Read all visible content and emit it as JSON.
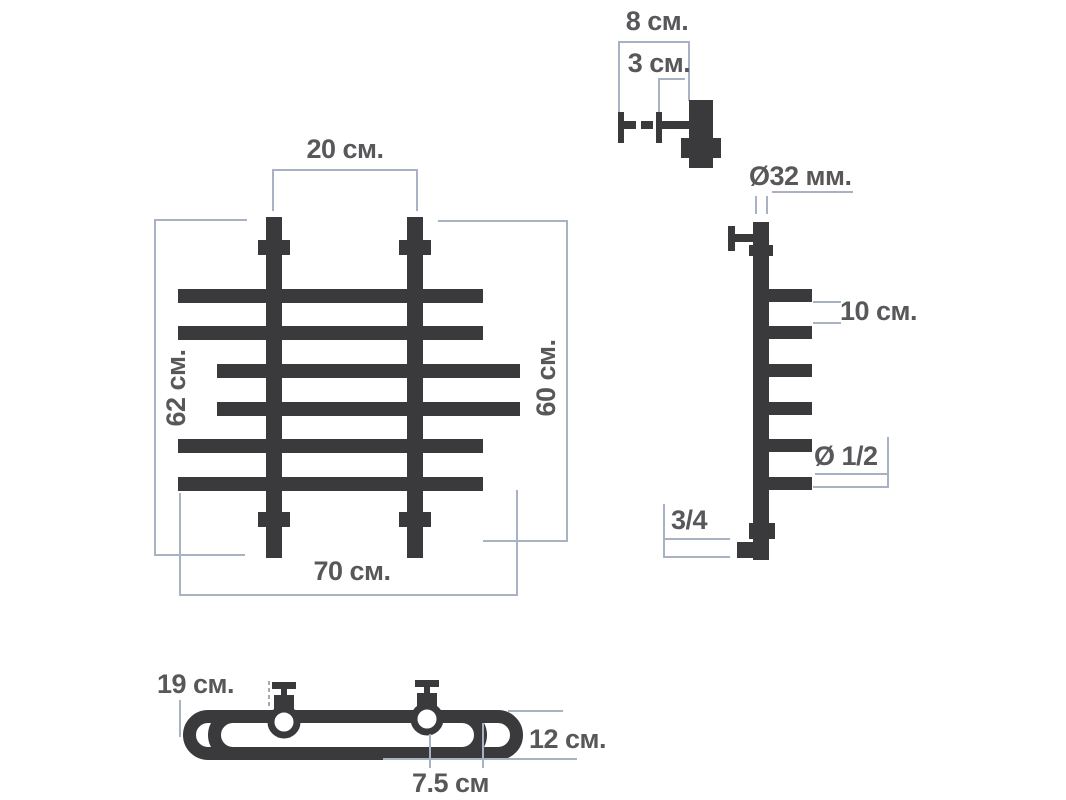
{
  "colors": {
    "pipe": "#3a3a3c",
    "dim": "#a8b2c2",
    "text": "#58585b",
    "dash": "#a9a9ad"
  },
  "front_view": {
    "top_width": "20 см.",
    "left_height": "62 см.",
    "right_height": "60 см.",
    "bottom_width": "70 см."
  },
  "bracket_detail": {
    "total_depth": "8 см.",
    "adjust_depth": "3 см."
  },
  "side_view": {
    "post_diameter": "Ø32 мм.",
    "bar_spacing": "10 см.",
    "bar_diameter": "Ø 1/2",
    "bottom_connection": "3/4"
  },
  "top_view": {
    "left_offset": "19 см.",
    "depth": "12 см.",
    "bar_overhang": "7.5 см"
  }
}
